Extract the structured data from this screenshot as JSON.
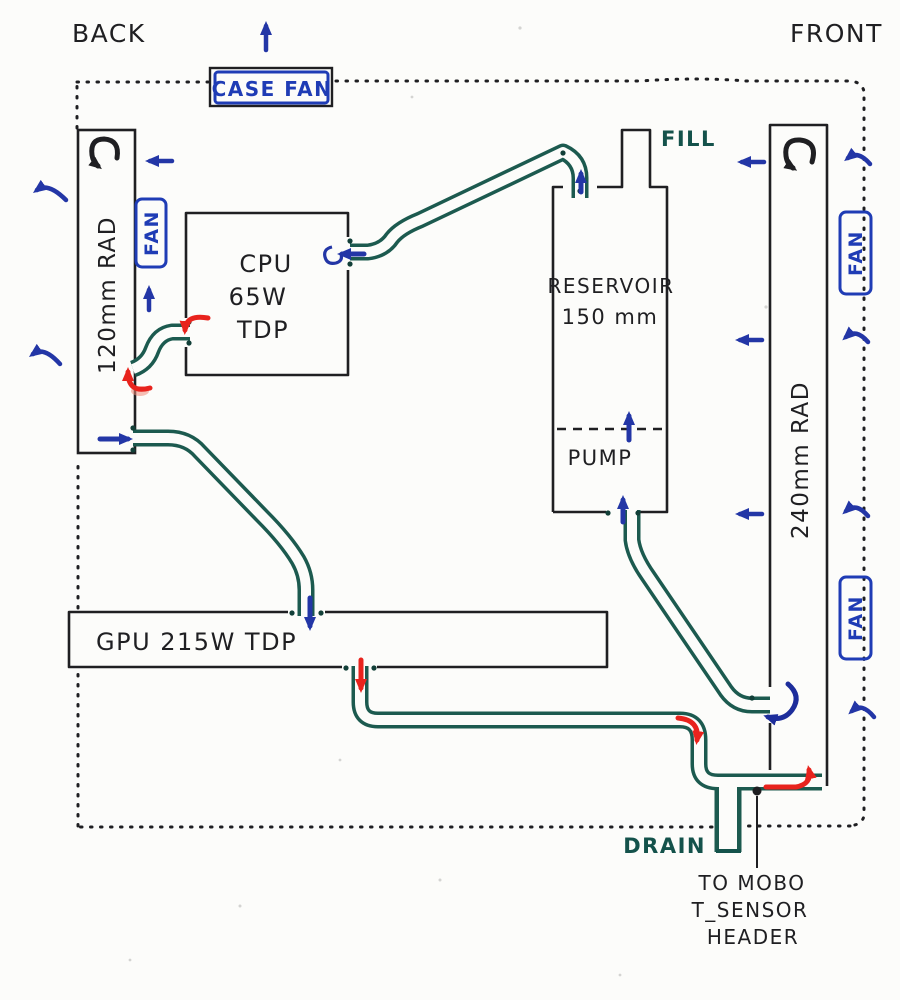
{
  "title": "Hand-drawn PC watercooling loop diagram",
  "orientation": {
    "back_label": "BACK",
    "front_label": "FRONT"
  },
  "case": {
    "fan_label": "CASE FAN"
  },
  "radiators": {
    "left": {
      "label": "120mm RAD",
      "fan_label": "FAN"
    },
    "right": {
      "label": "240mm RAD",
      "fan_labels": [
        "FAN",
        "FAN"
      ]
    }
  },
  "blocks": {
    "cpu": {
      "name": "CPU",
      "tdp": "65W",
      "tdp_suffix": "TDP"
    },
    "gpu": {
      "label": "GPU 215W TDP"
    }
  },
  "reservoir": {
    "name": "RESERVOIR",
    "size": "150 mm",
    "pump_label": "PUMP",
    "fill_label": "FILL"
  },
  "ports": {
    "drain_label": "DRAIN",
    "sensor_note": [
      "TO MOBO",
      "T_SENSOR",
      "HEADER"
    ]
  },
  "colors": {
    "ink": "#1f1f22",
    "airflow_blue": "#2336a6",
    "coolant_cold_blue": "#1d2d9b",
    "coolant_hot_red": "#e8231d",
    "tube_teal": "#1c5a4f",
    "label_teal": "#14524b",
    "fan_box_blue": "#1f3cb5",
    "paper": "#fcfcfa"
  }
}
